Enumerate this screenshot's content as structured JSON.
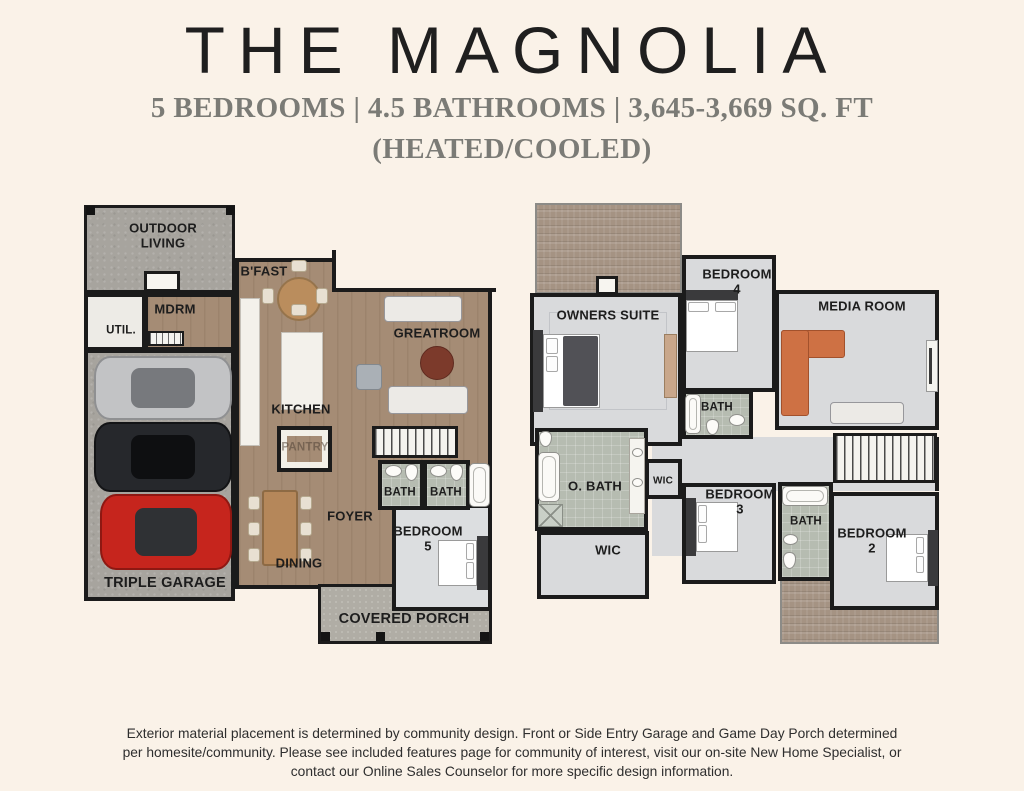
{
  "header": {
    "title": "THE MAGNOLIA",
    "subtitle": "5 BEDROOMS | 4.5 BATHROOMS | 3,645-3,669 SQ. FT",
    "subtitle2": "(HEATED/COOLED)"
  },
  "first_floor": {
    "outdoor_living": "OUTDOOR LIVING",
    "util": "UTIL.",
    "mdrm": "MDRM",
    "bfast": "B'FAST",
    "greatroom": "GREATROOM",
    "kitchen": "KITCHEN",
    "pantry": "PANTRY",
    "bath_a": "BATH",
    "bath_b": "BATH",
    "foyer": "FOYER",
    "bedroom5": "BEDROOM 5",
    "dining": "DINING",
    "garage": "TRIPLE GARAGE",
    "porch": "COVERED PORCH"
  },
  "second_floor": {
    "owners_suite": "OWNERS SUITE",
    "bedroom4": "BEDROOM 4",
    "media_room": "MEDIA ROOM",
    "bath_hall": "BATH",
    "owners_bath": "O. BATH",
    "wic_small": "WIC",
    "bedroom3": "BEDROOM 3",
    "wic_large": "WIC",
    "bath_2": "BATH",
    "bedroom2": "BEDROOM 2"
  },
  "footer": {
    "disclaimer": "Exterior material placement is determined by community design. Front or Side Entry Garage and Game Day Porch determined per homesite/community. Please see included features page for community of interest, visit our on-site New Home Specialist, or contact our Online Sales Counselor for more specific design information."
  },
  "colors": {
    "background": "#FAF2E8",
    "title_text": "#1F1F1F",
    "subtitle_text": "#7B7B76",
    "wall": "#1B1B1B",
    "wood_floor": "#A58C75",
    "concrete_floor": "#A7A49E",
    "upper_floor": "#D9DADC",
    "tile_floor": "#B6BCB1",
    "roof_shingle": "#A59383",
    "car_silver": "#C2C3C5",
    "car_black": "#26282C",
    "car_red": "#C6251D",
    "sofa_orange": "#CE7144"
  }
}
